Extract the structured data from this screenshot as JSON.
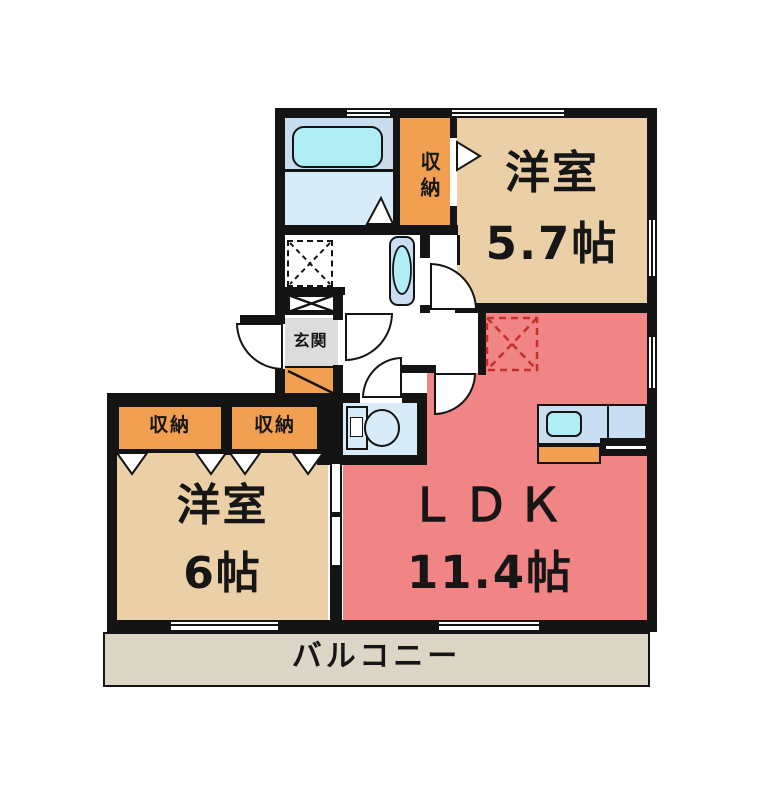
{
  "plan": {
    "rooms": {
      "western_upper": {
        "label": "洋室",
        "area": "5.7帖"
      },
      "western_lower": {
        "label": "洋室",
        "area": "6帖"
      },
      "ldk": {
        "label": "ＬＤＫ",
        "area": "11.4帖"
      },
      "balcony": {
        "label": "バルコニー"
      },
      "entrance": {
        "label": "玄関"
      },
      "storage_hall": {
        "label": "収納"
      },
      "storage_left": {
        "label": "収納"
      },
      "storage_right": {
        "label": "収納"
      }
    },
    "colors": {
      "wall": "#141414",
      "room_tan": "#ebcfa7",
      "room_pink": "#f18484",
      "storage_orange": "#f0a050",
      "balcony_gray": "#dcd6c7",
      "entrance_gray": "#dcdcdc",
      "bath_blue": "#d7ecf8",
      "bath_panel_blue": "#c8ddee",
      "fixture_cyan": "#aeeef4",
      "counter_blue": "#c9def2",
      "fridge_dash_red": "#c2302a"
    }
  }
}
